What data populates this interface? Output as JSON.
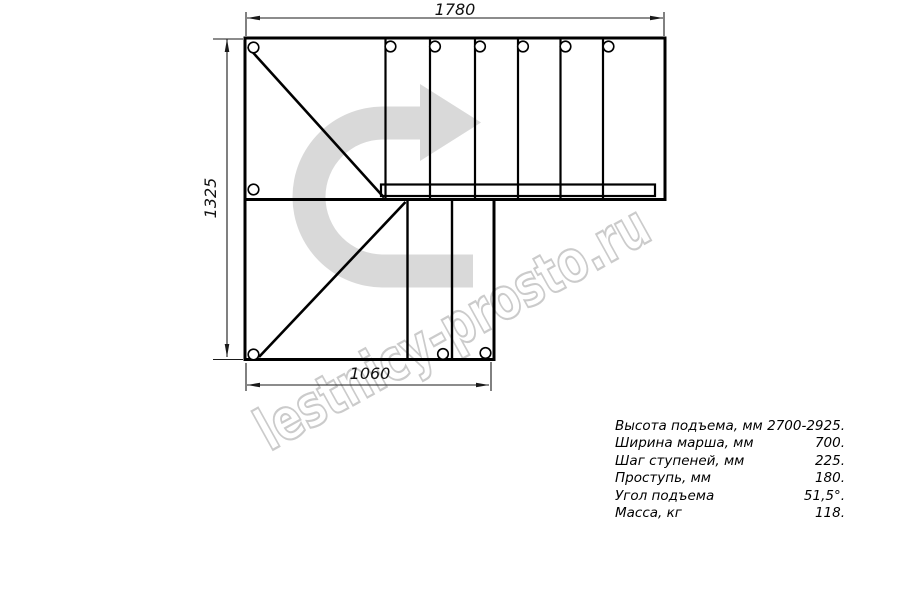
{
  "drawing": {
    "dimensions": {
      "top_mm": "1780",
      "left_mm": "1325",
      "bottom_mm": "1060"
    },
    "colors": {
      "line": "#000000",
      "dimension_line": "#1a1a1a",
      "direction_arrow_fill": "#d9d9d9",
      "watermark_outline": "#c2c2c2",
      "background": "#ffffff"
    }
  },
  "watermark": {
    "text": "lestnicy-prosto.ru"
  },
  "specs": {
    "rows": [
      {
        "label": "Высота подъема, мм",
        "value": "2700-2925."
      },
      {
        "label": "Ширина марша, мм",
        "value": "700."
      },
      {
        "label": "Шаг ступеней, мм",
        "value": "225."
      },
      {
        "label": "Проступь, мм",
        "value": "180."
      },
      {
        "label": "Угол подъема",
        "value": "51,5°."
      },
      {
        "label": "Масса, кг",
        "value": "118."
      }
    ]
  }
}
